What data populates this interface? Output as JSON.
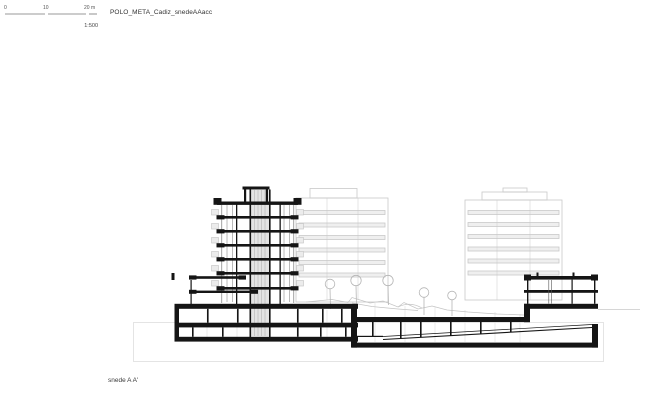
{
  "header": {
    "title": "POLO_META_Cadiz_snedeAAacc",
    "scale_bar": {
      "tick0": "0",
      "tick10": "10",
      "tick20": "20 m",
      "ratio_label": "1:500"
    }
  },
  "footer": {
    "caption": "snede A A'"
  },
  "colors": {
    "cut_black": "#151515",
    "elevation_gray": "#c9c9c9",
    "terrain_gray": "#c4c4c4",
    "site_boundary_gray": "#e2e2e2",
    "background": "#ffffff"
  },
  "drawing": {
    "type": "architectural-section",
    "scale": "1:500",
    "elements": [
      "scale-bar",
      "foreground-tower-section",
      "left-wing-section",
      "right-wing-section",
      "underground-parking-with-ramp",
      "background-building-left",
      "background-building-right",
      "trees",
      "terrain-line",
      "site-boundary-box"
    ]
  }
}
